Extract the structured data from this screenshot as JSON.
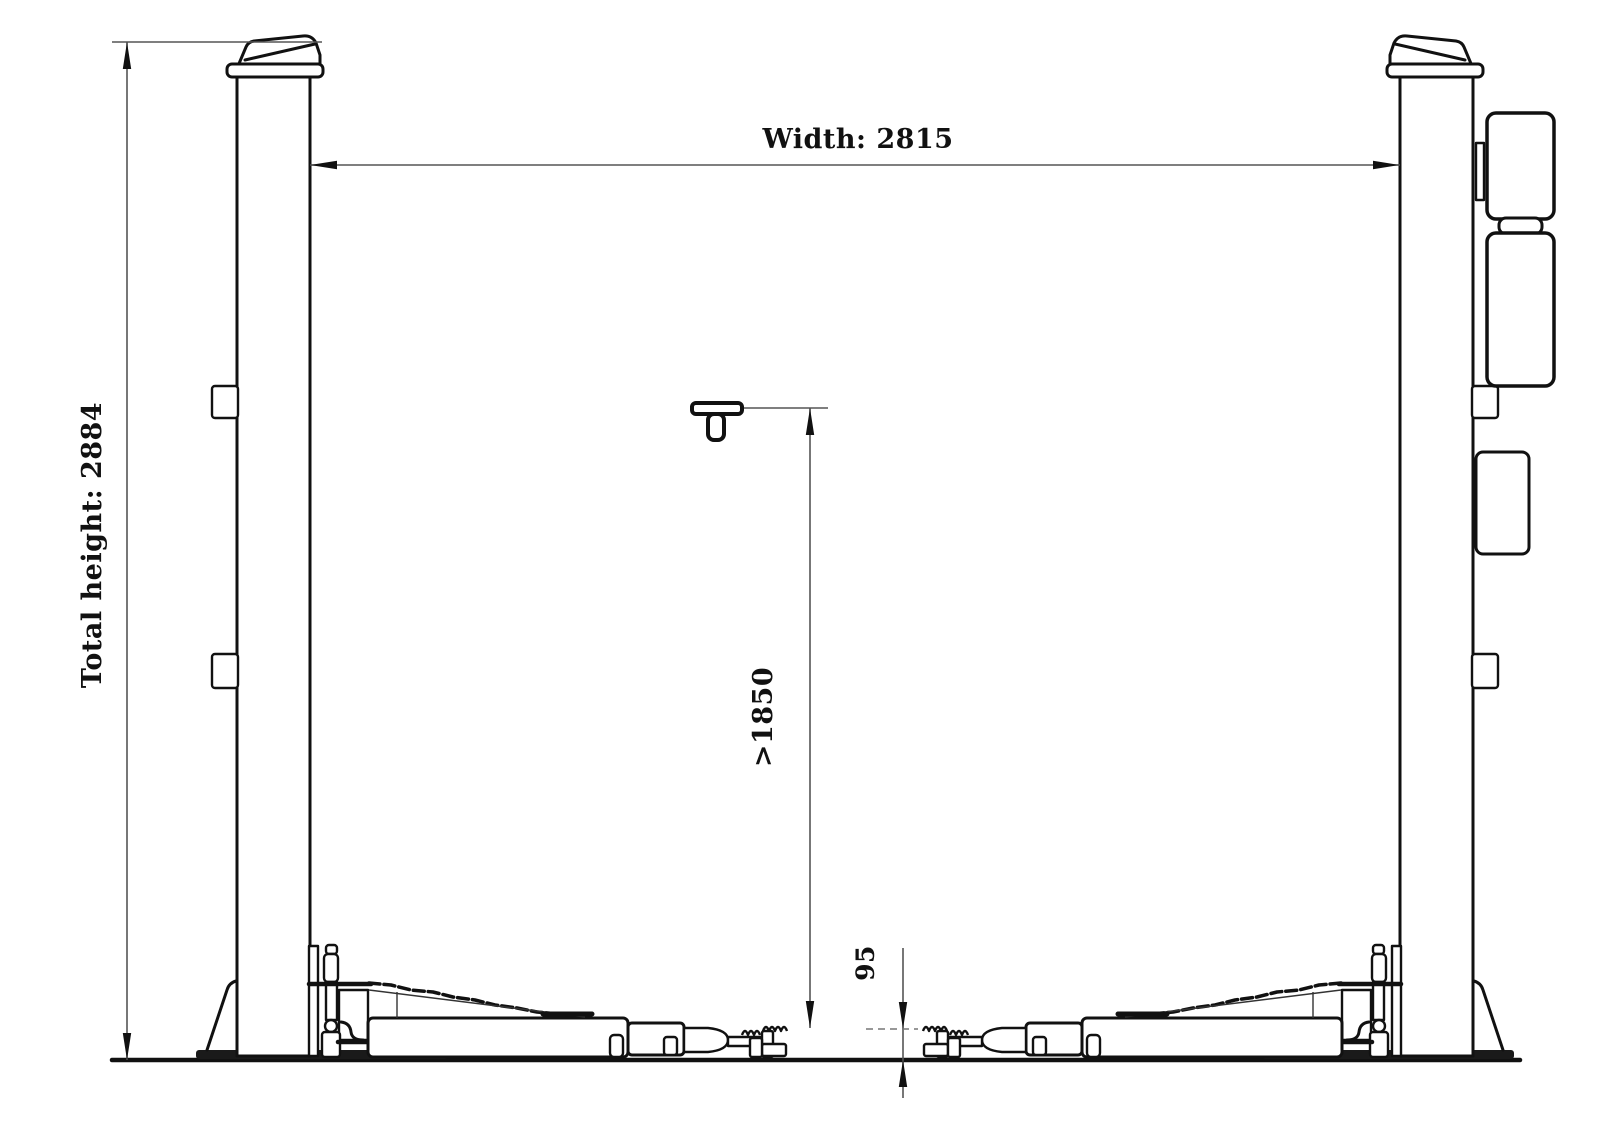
{
  "drawing": {
    "background": "#ffffff",
    "line_color": "#111111",
    "dim_line_color": "#555555",
    "labels": {
      "total_height": "Total height: 2884",
      "width": "Width: 2815",
      "lift_height": ">1850",
      "pad_height": "95"
    },
    "values": {
      "total_height_mm": 2884,
      "width_mm": 2815,
      "min_lift_height_mm": "greater than 1850",
      "pad_min_height_mm": 95
    }
  }
}
